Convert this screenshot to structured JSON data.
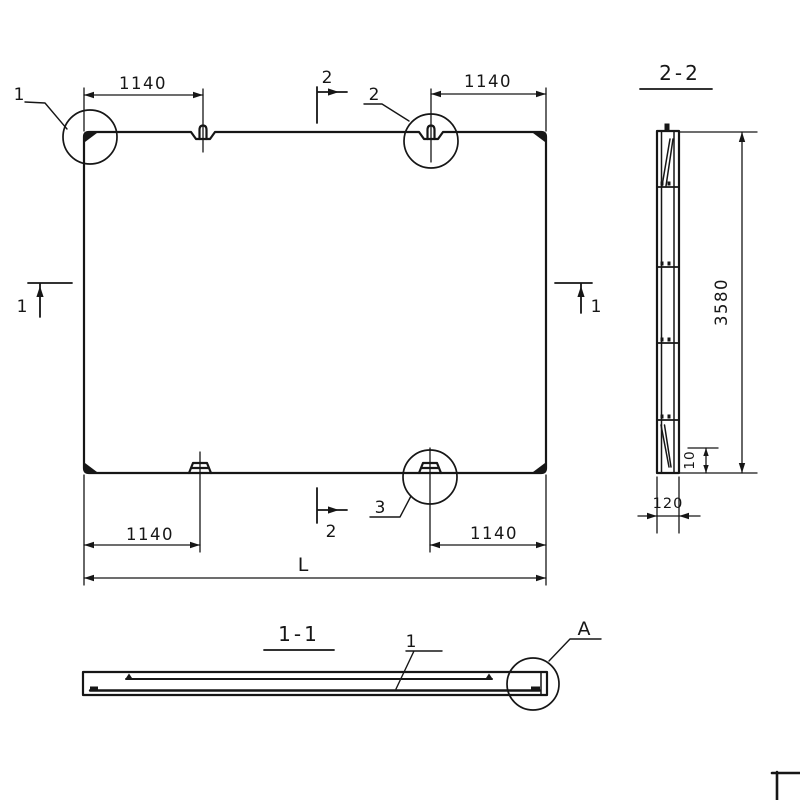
{
  "colors": {
    "ink": "#161616",
    "paper": "#ffffff"
  },
  "plan": {
    "dim_top_left": "1140",
    "dim_top_right": "1140",
    "dim_bottom_left": "1140",
    "dim_bottom_right": "1140",
    "dim_overall_length": "L",
    "detail_circle_1": "1",
    "detail_circle_2": "2",
    "detail_circle_3": "3",
    "section_mark_left": "1",
    "section_mark_right": "1",
    "section_mark_top": "2",
    "section_mark_bottom": "2"
  },
  "section_2_2": {
    "title": "2-2",
    "dim_height": "3580",
    "dim_edge_offset": "10",
    "dim_thickness": "120"
  },
  "section_1_1": {
    "title": "1-1",
    "rebar_callout": "1",
    "detail_callout": "A"
  }
}
